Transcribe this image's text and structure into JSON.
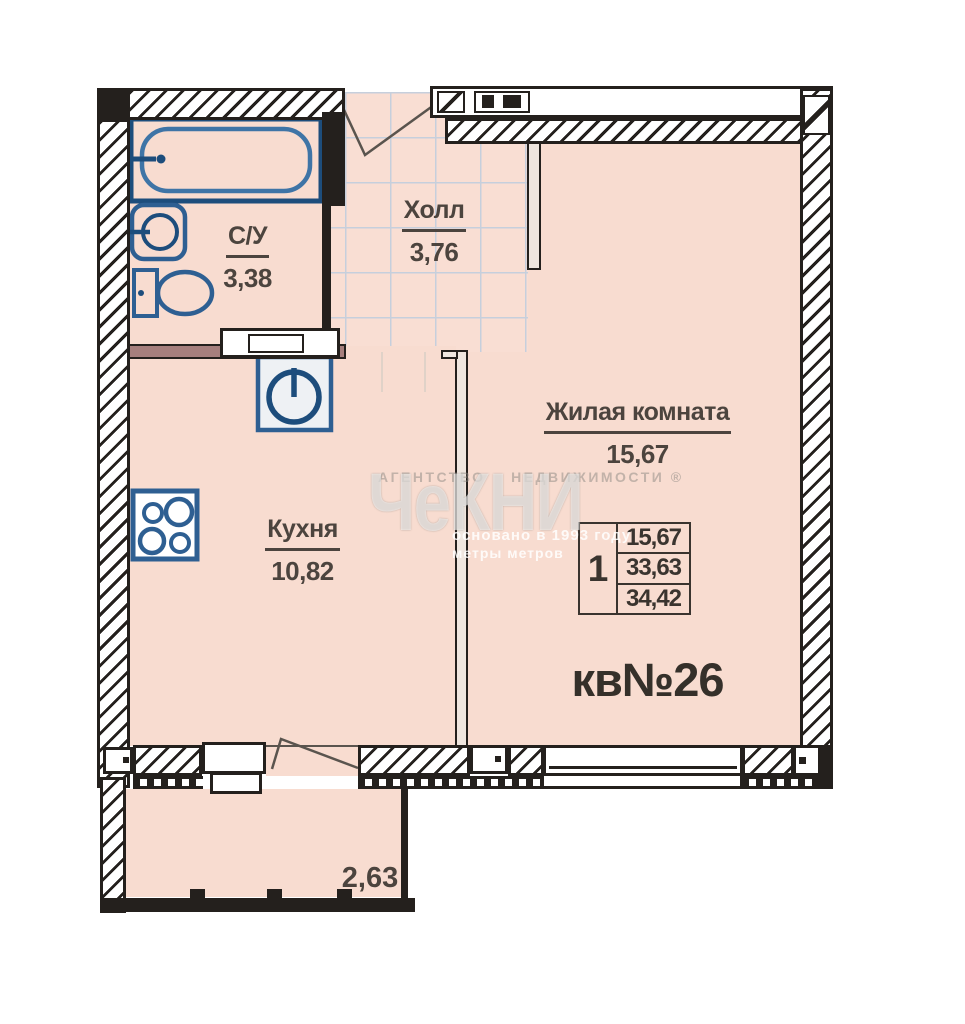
{
  "watermark": {
    "agency_line": "АГЕНТСТВО    НЕДВИЖИМОСТИ ®",
    "logo": "ЧеКНИ",
    "founded": "основано в 1993 году",
    "tagline": "метры метров"
  },
  "plan": {
    "apartment_label": "кв№26",
    "rooms": [
      {
        "name": "С/У",
        "area": "3,38"
      },
      {
        "name": "Холл",
        "area": "3,76"
      },
      {
        "name": "Жилая комната",
        "area": "15,67"
      },
      {
        "name": "Кухня",
        "area": "10,82"
      }
    ],
    "balcony_area": "2,63",
    "info_table": {
      "rooms_count": "1",
      "living_area": "15,67",
      "area_wo_balcony": "33,63",
      "total_area": "34,42"
    },
    "icons": [
      "bathtub-icon",
      "sink-icon",
      "toilet-icon",
      "washing-machine-icon",
      "stove-icon",
      "entrance-door-swing-icon",
      "balcony-door-swing-icon"
    ],
    "colors": {
      "floor": "#f8dcd0",
      "wall": "#24201d",
      "fixture_blue": "#2e5f92",
      "fixture_blue_dark": "#1d4d7c",
      "tile_grid": "#c6cfdc",
      "label_text": "#4c443e",
      "partition_brown": "#a67f7d"
    }
  }
}
